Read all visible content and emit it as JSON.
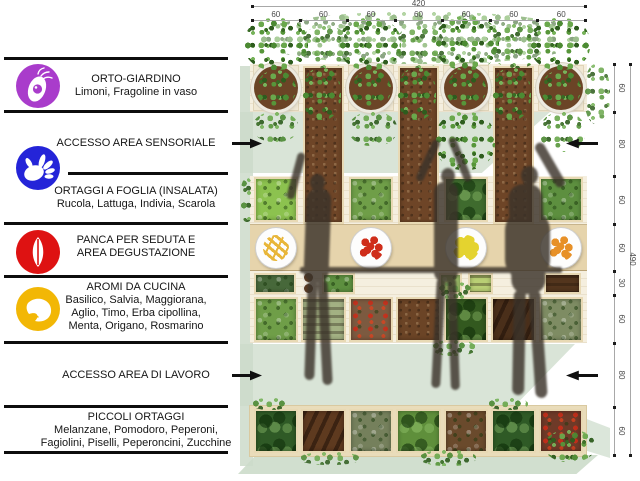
{
  "dimensions": {
    "top": {
      "total": "420",
      "segments": [
        "60",
        "60",
        "60",
        "60",
        "60",
        "60",
        "60"
      ]
    },
    "right": {
      "total": "490",
      "segments": [
        "60",
        "80",
        "60",
        "60",
        "30",
        "60",
        "80",
        "60"
      ]
    }
  },
  "legend": {
    "items": [
      {
        "name": "orto-giardino",
        "lines": [
          "ORTO-GIARDINO",
          "Limoni, Fragoline in vaso"
        ]
      },
      {
        "name": "accesso-area-sensoriale",
        "lines": [
          "ACCESSO AREA SENSORIALE"
        ],
        "arrow": true
      },
      {
        "name": "ortaggi-a-foglia",
        "lines": [
          "ORTAGGI A FOGLIA (INSALATA)",
          "Rucola, Lattuga, Indivia, Scarola"
        ]
      },
      {
        "name": "panca-degustazione",
        "lines": [
          "PANCA PER SEDUTA E",
          "AREA DEGUSTAZIONE"
        ]
      },
      {
        "name": "aromi-da-cucina",
        "lines": [
          "AROMI DA CUCINA",
          "Basilico, Salvia, Maggiorana,",
          "Aglio, Timo, Erba cipollina,",
          "Menta, Origano, Rosmarino"
        ]
      },
      {
        "name": "accesso-area-di-lavoro",
        "lines": [
          "ACCESSO AREA DI LAVORO"
        ],
        "arrow": true
      },
      {
        "name": "piccoli-ortaggi",
        "lines": [
          "PICCOLI ORTAGGI",
          "Melanzane, Pomodoro, Peperoni,",
          "Fagiolini, Piselli, Peperoncini, Zucchine"
        ]
      }
    ],
    "icon_colors": {
      "eye": "#a93ccb",
      "hand": "#2424d8",
      "lips": "#de1212",
      "nose": "#f2b705"
    }
  },
  "plan": {
    "columns": 7,
    "soil_color": "#6e4527",
    "wood_color": "#e6d4ac",
    "shadow_color": "#ccdbca",
    "plates": [
      {
        "name": "fries-plate",
        "color": "#e8b63a",
        "pattern": "sticks"
      },
      {
        "name": "strawberries-plate",
        "color": "#cf2d1a",
        "pattern": "dots"
      },
      {
        "name": "lemon-slices-plate",
        "color": "#e4d32f",
        "pattern": "slices"
      },
      {
        "name": "oranges-plate",
        "color": "#e79027",
        "pattern": "dots"
      }
    ],
    "cells": {
      "salad": [
        {
          "col": 0,
          "color": "#8cc24f",
          "tex": "leaf"
        },
        {
          "col": 2,
          "color": "#6f9e48",
          "tex": "leaf"
        },
        {
          "col": 4,
          "color": "#3f6b2e",
          "tex": "bush"
        },
        {
          "col": 6,
          "color": "#5d8f3f",
          "tex": "leaf"
        }
      ],
      "small_herbs": [
        {
          "col": 0,
          "w": 0.95,
          "color": "#47683a",
          "tex": "leaf"
        },
        {
          "col": 1.45,
          "w": 0.75,
          "color": "#5d8f3f",
          "tex": "leaf"
        },
        {
          "col": 3.9,
          "w": 0.55,
          "color": "#9fc06a",
          "tex": "leaf"
        },
        {
          "col": 4.5,
          "w": 0.6,
          "color": "#b9cf74",
          "tex": "rows"
        },
        {
          "col": 6.1,
          "w": 0.85,
          "color": "#53351d",
          "tex": "rows"
        }
      ],
      "aromi": [
        {
          "col": 0,
          "color": "#6f9e48",
          "tex": "leaf"
        },
        {
          "col": 1,
          "color": "#a3b183",
          "tex": "rows"
        },
        {
          "col": 2,
          "color": "#7c5a40",
          "tex": "red"
        },
        {
          "col": 3,
          "color": "#6b4426",
          "tex": "soil"
        },
        {
          "col": 4,
          "color": "#33591f",
          "tex": "bush"
        },
        {
          "col": 5,
          "color": "#4a2f1a",
          "tex": "streak"
        },
        {
          "col": 6,
          "color": "#7e8c63",
          "tex": "leaf"
        }
      ],
      "piccoli": [
        {
          "col": 0,
          "color": "#2f5a26",
          "tex": "bush"
        },
        {
          "col": 1,
          "color": "#5e3a1f",
          "tex": "streak"
        },
        {
          "col": 2,
          "color": "#75805c",
          "tex": "leaf"
        },
        {
          "col": 3,
          "color": "#5f8f3b",
          "tex": "bush"
        },
        {
          "col": 4,
          "color": "#6a4a2c",
          "tex": "leaf"
        },
        {
          "col": 5,
          "color": "#2f5a26",
          "tex": "bush"
        },
        {
          "col": 6,
          "color": "#6e3a28",
          "tex": "red"
        }
      ]
    }
  }
}
